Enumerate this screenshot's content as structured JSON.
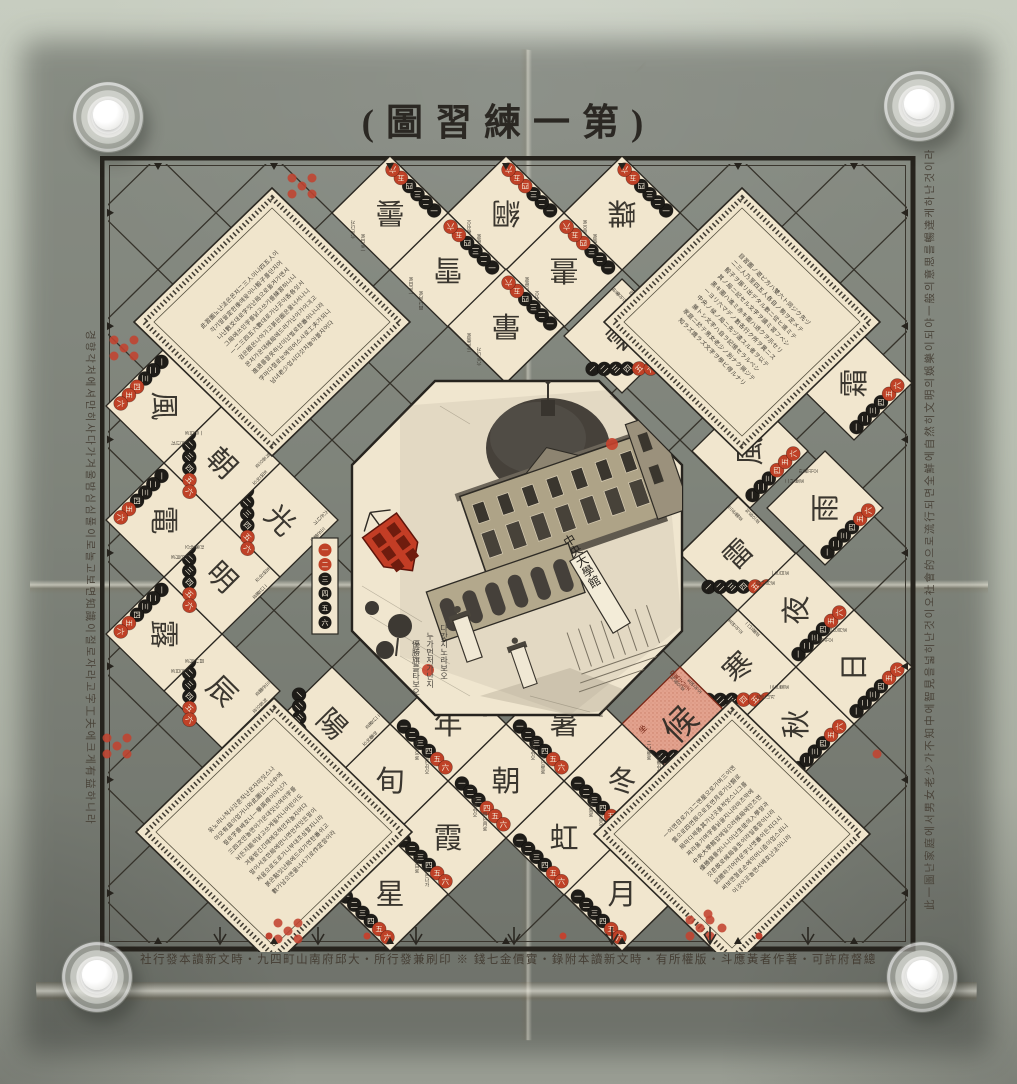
{
  "photo": {
    "wall_color": "#b9bfb2",
    "paper_color": "#e9dcc0",
    "ink_color": "#2b2823",
    "accent_red": "#c0452c",
    "goal_pink": "#e3a28e"
  },
  "title": "(圖習練一第)",
  "colophon": "社行發本讀新文時・九四町山南府邱大・所行發兼刷印 ※ 錢七金價實・錄附本讀新文時・有所權版・斗應黃者作著・可許府督總",
  "margins": {
    "right": "此一圖난家庭에서男女老少가不知中에智見을넓히난것이오社會的으로流行되면全鮮에自然히文明의娛樂이되야一般의意思를暢達케하난것이라",
    "left": "경향각처에셔만히사다가겨울밤심심풀이로놀고보면知識이절로자라고字工夫에크게有益하니라"
  },
  "board": {
    "dice_numerals": [
      "一",
      "二",
      "三",
      "四",
      "五",
      "六"
    ],
    "cell_notes": [
      "一은日로",
      "二난星로",
      "三은雲로",
      "四난月로",
      "五면쉬오",
      "六은나가",
      "한番쉬오",
      "처음으로"
    ],
    "cells": [
      {
        "c": "曇",
        "x": 290,
        "y": 57,
        "r": 180
      },
      {
        "c": "綱",
        "x": 406,
        "y": 57,
        "r": 180,
        "red": 3
      },
      {
        "c": "蝶",
        "x": 522,
        "y": 57,
        "r": 180
      },
      {
        "c": "雪",
        "x": 348,
        "y": 114,
        "r": 180
      },
      {
        "c": "晝",
        "x": 464,
        "y": 114,
        "r": 180,
        "red": 3
      },
      {
        "c": "暈",
        "x": 406,
        "y": 170,
        "r": 180
      },
      {
        "c": "雲",
        "x": 522,
        "y": 180,
        "r": -45
      },
      {
        "c": "霜",
        "x": 754,
        "y": 227,
        "r": -90
      },
      {
        "c": "風",
        "x": 650,
        "y": 295,
        "r": -90,
        "red": 3
      },
      {
        "c": "雨",
        "x": 725,
        "y": 352,
        "r": -90
      },
      {
        "c": "雷",
        "x": 638,
        "y": 398,
        "r": -45
      },
      {
        "c": "夜",
        "x": 696,
        "y": 454,
        "r": -90
      },
      {
        "c": "寒",
        "x": 638,
        "y": 511,
        "r": -45,
        "red": 3
      },
      {
        "c": "秋",
        "x": 696,
        "y": 568,
        "r": -90
      },
      {
        "c": "日",
        "x": 754,
        "y": 511,
        "r": -90
      },
      {
        "c": "候",
        "x": 580,
        "y": 568,
        "r": -45,
        "goal": true
      },
      {
        "c": "月",
        "x": 522,
        "y": 738,
        "r": 0
      },
      {
        "c": "冬",
        "x": 522,
        "y": 625,
        "r": 0
      },
      {
        "c": "虹",
        "x": 464,
        "y": 682,
        "r": 0
      },
      {
        "c": "暑",
        "x": 464,
        "y": 568,
        "r": 0
      },
      {
        "c": "朝",
        "x": 406,
        "y": 625,
        "r": 0,
        "red": 3
      },
      {
        "c": "年",
        "x": 348,
        "y": 568,
        "r": 0
      },
      {
        "c": "霞",
        "x": 348,
        "y": 682,
        "r": 0
      },
      {
        "c": "旬",
        "x": 290,
        "y": 625,
        "r": 0
      },
      {
        "c": "星",
        "x": 290,
        "y": 738,
        "r": 0
      },
      {
        "c": "陽",
        "x": 232,
        "y": 568,
        "r": 45
      },
      {
        "c": "辰",
        "x": 122,
        "y": 535,
        "r": 45
      },
      {
        "c": "露",
        "x": 64,
        "y": 478,
        "r": 90
      },
      {
        "c": "明",
        "x": 122,
        "y": 421,
        "r": 45
      },
      {
        "c": "光",
        "x": 180,
        "y": 364,
        "r": 45
      },
      {
        "c": "電",
        "x": 64,
        "y": 364,
        "r": 90
      },
      {
        "c": "朝",
        "x": 122,
        "y": 307,
        "r": 45
      },
      {
        "c": "風",
        "x": 64,
        "y": 250,
        "r": 90,
        "red": 3
      },
      {
        "c": "",
        "x": 225,
        "y": 430,
        "r": 0,
        "strip": true
      }
    ],
    "goal_labels": {
      "side": "空氣잇난곳",
      "bottom": "生",
      "seat": "坐"
    },
    "panels": [
      {
        "id": "tl",
        "x": 172,
        "y": 166,
        "rot": -45,
        "lines": [
          "此習圖노난法은몬저二三人이나四五人이",
          "각기말을定한後에윳이나骰子를던지어",
          "나난數爻대로字잇난局으로옮겨가면서",
          "그局에쓰인字를낡고쓰기를練習하나니",
          "一二三四五六數대로가난곳이各各잇서",
          "검은圈은나아가고붉은圈은물너서나니",
          "몬저가온대候局에드러가난이가이긔고",
          "進退를잘못하난이난벌로한番쉬나니라",
          "字마다절로눈에익어스사로工夫가되니",
          "남녀老少업시다갓치놀아볼지어다"
        ]
      },
      {
        "id": "tr",
        "x": 642,
        "y": 166,
        "rot": 45,
        "lines": [
          "目習圖ノ遊ビ方ハ雙六ト同ジク先ヅ",
          "二三人乃至四五人各自ノ駒ヲ定メテ",
          "骰子ヲ振リ出デタル數ニ從ヒ進ミテ",
          "其ノ局ニ記セル文字ヲ讀ミ習フベシ",
          "黑キ圈ハ進ミ赤キ圈ハ退クヲ示セリ",
          "一ヨリ六マデノ數各行ク所ヲ異ニス",
          "中央ノ候ノ局ニ先ヅ達スル者ヲ以テ",
          "勝トシ文字ハ自ラ記憶セラルベシ",
          "家庭ニ於テ男女老少ノ別ナク興ジテ",
          "知ラズ識ラズ文字ヲ學ビ得ルナリ"
        ]
      },
      {
        "id": "bl",
        "x": 174,
        "y": 676,
        "rot": -45,
        "lines": [
          "윳노리나척사갓흔작난은자미잇스나",
          "아모有益이업거니와此圖난노난中에",
          "절로字를배호니一擧兩得이아닌가",
          "三四次만놀면이가온대잇난여러字를",
          "뉘든지能히낡고쓰게될지니어린이도",
          "겨울밤긴긴때에모혀안저놀지어다",
          "말이서로한局에만나면먼저잇든말이",
          "처음으로도로가니부대조심할지니라",
          "붉은點잇난局에드러가면한番쉬고",
          "數가남으면물너서기로作定함이라"
        ]
      },
      {
        "id": "br",
        "x": 632,
        "y": 678,
        "rot": -45,
        "lines": [
          "一이면日로가고二면星으로가며三이면",
          "雲으로四면辰으로五면月로가난類로",
          "局마다제各其가난곳을적엇스니그를",
          "짜라옮기며字를닑을지니라마즈막에",
          "中央大學館압헤일으러候局에안즈면",
          "優勝旗를엇나니이난生徒의入學함과",
          "갓흔故로候局을生이라일홈함이니라",
          "記臆하기어려운字난몃番이든지다시",
          "써보면절로손에익어니즘이업스리니",
          "이것이곳놀면서배호난法이니라"
        ]
      }
    ],
    "center": {
      "sign": "中央大學館",
      "caption_lines": [
        "다갓치노라보오",
        "누가먼저가난지",
        "優勝旗를타보오"
      ]
    },
    "decorations": {
      "quincunx_clusters": [
        [
          202,
          30
        ],
        [
          24,
          192
        ],
        [
          17,
          590
        ],
        [
          188,
          775
        ],
        [
          600,
          772
        ]
      ],
      "single_dots": [
        [
          777,
          598
        ],
        [
          608,
          758
        ],
        [
          622,
          772
        ]
      ],
      "chevron_xs": [
        120,
        218,
        316,
        414,
        512,
        610,
        708
      ],
      "chevron_dot_xs": [
        169,
        267,
        463,
        659
      ]
    }
  }
}
